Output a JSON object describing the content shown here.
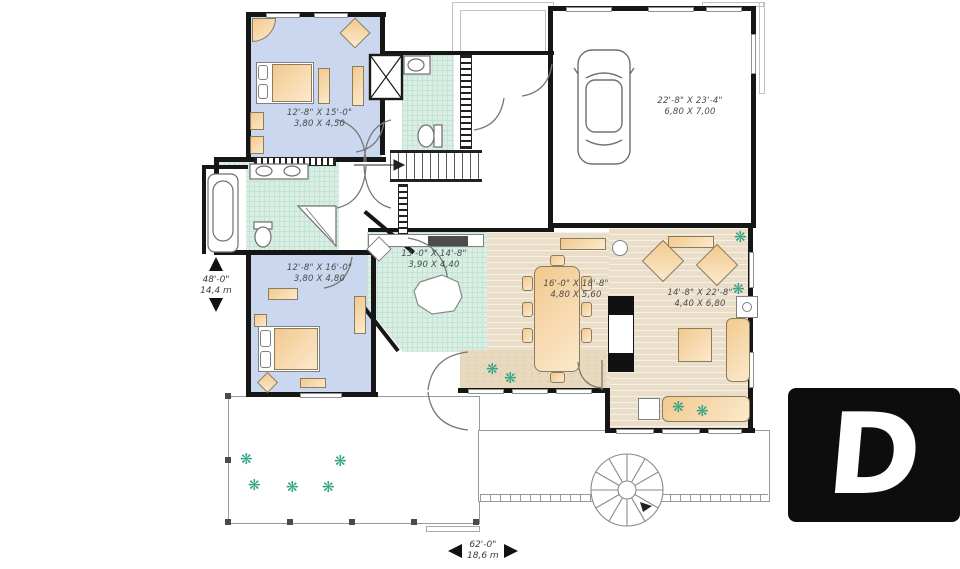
{
  "rooms": {
    "bedroom_top": {
      "imperial": "12'-8\" X 15'-0\"",
      "metric": "3,80 X 4,50"
    },
    "bedroom_bottom": {
      "imperial": "12'-8\" X 16'-0\"",
      "metric": "3,80 X 4,80"
    },
    "kitchen_dinette": {
      "imperial": "13'-0\" X 14'-8\"",
      "metric": "3,90 X 4,40"
    },
    "dining_room": {
      "imperial": "16'-0\" X 18'-8\"",
      "metric": "4,80 X 5,60"
    },
    "living_room": {
      "imperial": "14'-8\" X 22'-8\"",
      "metric": "4,40 X 6,80"
    },
    "garage": {
      "imperial": "22'-8\" X 23'-4\"",
      "metric": "6,80 X 7,00"
    }
  },
  "overall_dimensions": {
    "depth": {
      "imperial": "48'-0\"",
      "metric": "14,4 m"
    },
    "width": {
      "imperial": "62'-0\"",
      "metric": "18,6 m"
    }
  },
  "icons": {
    "plant": "❋"
  },
  "logo": {
    "letter": "D"
  },
  "colors": {
    "bedroom_fill": "#cbd7ee",
    "bath_tile_fill": "#daeee6",
    "wood_floor_fill": "#eadec9",
    "furniture_fill": "#f2c98e",
    "wall": "#161616",
    "plant": "#2ea284",
    "logo_background": "#0d0d0d"
  }
}
